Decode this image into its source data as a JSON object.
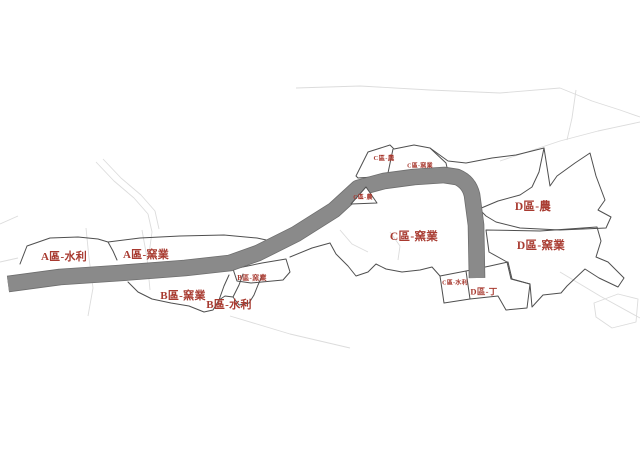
{
  "colors": {
    "background": "#ffffff",
    "band_fill": "#8a8a8a",
    "band_edge": "#6e6e6e",
    "border": "#4f4f4f",
    "faint_line": "#dcdcdc",
    "label_red": "#a83a30"
  },
  "map": {
    "band": {
      "name": "gray-corridor-band",
      "path": "M 8,284 L 60,277 L 120,273 L 185,268 L 230,263 L 258,253 L 296,234 L 334,210 L 358,188 L 384,181 L 414,177 L 444,175 L 457,177 Q 469,182 472,195 L 476,225 L 477,278",
      "width": 15
    },
    "regions": [
      {
        "name": "zone-a-water",
        "path": "M 20,264 L 27,246 L 50,238 L 78,237 L 98,239 L 108,242 L 113,251 L 117,260"
      },
      {
        "name": "zone-a-kiln-top-border",
        "path": "M 108,242 L 140,238 L 180,236 L 224,235 L 257,238 L 271,241 L 287,235 L 297,228 L 307,231 L 321,215"
      },
      {
        "name": "zone-b-outer-border",
        "path": "M 128,282 L 138,292 L 152,299 L 171,303 L 189,306 L 204,312 L 213,310 L 219,300 L 225,296 L 233,297 L 239,305 L 249,303 L 254,295 L 258,285 L 262,276"
      },
      {
        "name": "zone-b-divider-left",
        "path": "M 219,300 L 224,286 L 229,275"
      },
      {
        "name": "zone-b-divider-right",
        "path": "M 233,297 L 239,285 L 243,274"
      },
      {
        "name": "zone-b-kiln-small",
        "path": "M 233,269 L 262,263 L 286,259 L 290,272 L 283,280 L 251,283 L 237,281 Z"
      },
      {
        "name": "under-band-boundary",
        "path": "M 290,257 L 312,248 L 330,243"
      },
      {
        "name": "zone-c-bottom-border",
        "path": "M 330,243 L 336,254 L 348,266 L 356,276 L 368,272 L 376,264 L 386,269 L 402,272 L 420,270 L 432,267 L 440,276"
      },
      {
        "name": "zone-c-water",
        "path": "M 440,276 L 466,271 L 470,299 L 444,303 Z"
      },
      {
        "name": "zone-d-ding",
        "path": "M 466,271 L 490,266 L 508,262 L 512,279 L 530,284 L 527,308 L 506,310 L 498,296 L 470,299"
      },
      {
        "name": "zone-d-agri",
        "path": "M 479,209 L 498,201 L 520,195 L 532,187 L 539,172 L 544,148 L 550,186 L 557,176 L 575,163 L 590,153 L 596,176 L 605,200 L 598,210 L 611,217 L 606,228 L 560,230 L 520,228 L 496,222 L 486,216 Z"
      },
      {
        "name": "zone-d-kiln",
        "path": "M 486,230 L 540,231 L 597,227 L 601,241 L 596,257 L 608,262 L 624,278 L 618,287 L 599,278 L 585,269 L 567,286 L 561,293 L 543,295 L 532,307 L 530,284 L 511,279 L 507,262 L 489,252 Z"
      },
      {
        "name": "upper-boundary-to-d",
        "path": "M 430,148 L 448,161 L 466,163 L 492,158 L 516,155 L 544,148"
      }
    ],
    "pre_band_overlays": [
      {
        "name": "zone-c-top-small-polys",
        "path": "M 356,176 L 368,152 L 390,145 L 394,149 L 414,145 L 430,148 L 446,163 L 448,172 L 358,178 Z",
        "fill": "#ffffff"
      },
      {
        "name": "zone-c-top-divider",
        "path": "M 393,149 L 388,173",
        "fill": "none"
      }
    ],
    "post_band_overlays": [
      {
        "name": "zone-c-agri-wedge",
        "path": "M 351,204 L 366,187 L 377,203 Z",
        "fill": "#ffffff"
      }
    ],
    "faint_lines": [
      "M 96,162 L 114,181 L 134,198 L 148,214 L 152,232 L 149,254",
      "M 103,159 L 121,178 L 141,195 L 155,211 L 159,229",
      "M 86,228 L 89,258 L 93,288 L 88,316",
      "M 142,230 L 147,258 L 150,290",
      "M 0,224 L 18,216",
      "M 0,262 L 18,258",
      "M 296,88 L 360,86 L 430,90 L 500,93 L 560,88",
      "M 560,88 L 592,101 L 620,110 L 640,117",
      "M 640,122 L 598,131 L 560,141 L 524,153 L 500,161",
      "M 576,90 L 572,118 L 567,140",
      "M 594,303 L 618,294 L 638,299 L 636,322 L 612,328 L 596,317 Z",
      "M 230,316 L 290,334 L 350,348",
      "M 560,272 L 600,296 L 640,318",
      "M 340,230 L 352,244 L 368,252",
      "M 390,232 L 400,246 L 398,260"
    ],
    "labels": [
      {
        "id": "a-water",
        "text": "A區-水利",
        "x": 64,
        "y": 260,
        "size": 11
      },
      {
        "id": "a-kiln",
        "text": "A區-窯業",
        "x": 146,
        "y": 258,
        "size": 11
      },
      {
        "id": "b-kiln-small",
        "text": "B區-窯業",
        "x": 252,
        "y": 280,
        "size": 7
      },
      {
        "id": "b-kiln",
        "text": "B區-窯業",
        "x": 183,
        "y": 299,
        "size": 11
      },
      {
        "id": "b-water",
        "text": "B區-水利",
        "x": 229,
        "y": 308,
        "size": 11
      },
      {
        "id": "c-agri-top",
        "text": "C區-農",
        "x": 384,
        "y": 160,
        "size": 6.5
      },
      {
        "id": "c-kiln-top",
        "text": "C區-窯業",
        "x": 420,
        "y": 167.5,
        "size": 6
      },
      {
        "id": "c-agri-bend",
        "text": "C區-農",
        "x": 363,
        "y": 199,
        "size": 6
      },
      {
        "id": "c-kiln",
        "text": "C區-窯業",
        "x": 414,
        "y": 240,
        "size": 11.5
      },
      {
        "id": "c-water",
        "text": "C區-水利",
        "x": 455,
        "y": 284.5,
        "size": 6
      },
      {
        "id": "d-agri",
        "text": "D區-農",
        "x": 533,
        "y": 210,
        "size": 11.5
      },
      {
        "id": "d-kiln",
        "text": "D區-窯業",
        "x": 541,
        "y": 249,
        "size": 11.5
      },
      {
        "id": "d-ding",
        "text": "D區-丁",
        "x": 484,
        "y": 294.5,
        "size": 8.5
      }
    ]
  }
}
